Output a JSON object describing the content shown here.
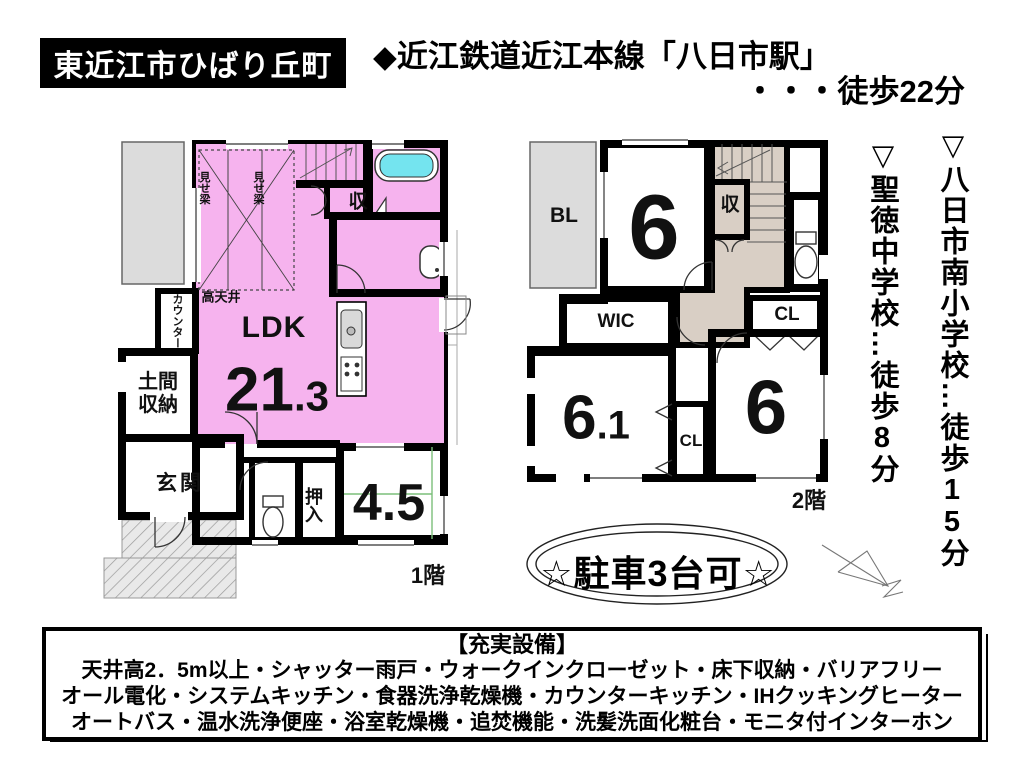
{
  "header": {
    "location_badge": "東近江市ひばり丘町",
    "station_line": "◆近江鉄道近江本線「八日市駅」",
    "station_walk": "・・・徒歩22分"
  },
  "schools": {
    "elementary_prefix": "▽八日市南小学校…徒歩",
    "elementary_minutes": "15",
    "elementary_suffix": "分",
    "junior_prefix": "▽聖徳中学校…徒歩",
    "junior_minutes": "8",
    "junior_suffix": "分"
  },
  "floor1": {
    "floor_label": "1階",
    "ldk_label": "LDK",
    "ldk_size_main": "21",
    "ldk_size_decimal": ".3",
    "tatami_size": "4.5",
    "labels": {
      "misebari": "見せ梁",
      "takatenjo": "高天井",
      "counter": "カウンター",
      "doma": "土間収納",
      "genkan": "玄関",
      "oshiire": "押入",
      "closet": "収"
    }
  },
  "floor2": {
    "floor_label": "2階",
    "balcony": "BL",
    "closet": "収",
    "wic": "WIC",
    "cl_top": "CL",
    "cl_mid": "CL",
    "room_a": "6",
    "room_b_main": "6",
    "room_b_decimal": ".1",
    "room_c": "6"
  },
  "parking": "☆駐車3台可☆",
  "equipment": {
    "title": "【充実設備】",
    "lines": [
      "天井高2．5m以上・シャッター雨戸・ウォークインクローゼット・床下収納・バリアフリー",
      "オール電化・システムキッチン・食器洗浄乾燥機・カウンターキッチン・IHクッキングヒーター",
      "オートバス・温水洗浄便座・浴室乾燥機・追焚機能・洗髪洗面化粧台・モニタ付インターホン"
    ]
  },
  "colors": {
    "room_pink": "#F6B3EE",
    "room_yellow": "#FAF5A0",
    "room_green": "#C9F7C5",
    "water_cyan": "#B4F0F6",
    "tub_water": "#74E4EF",
    "balcony_gray": "#DCDCDC",
    "stair_tan": "#D9CFC5"
  }
}
